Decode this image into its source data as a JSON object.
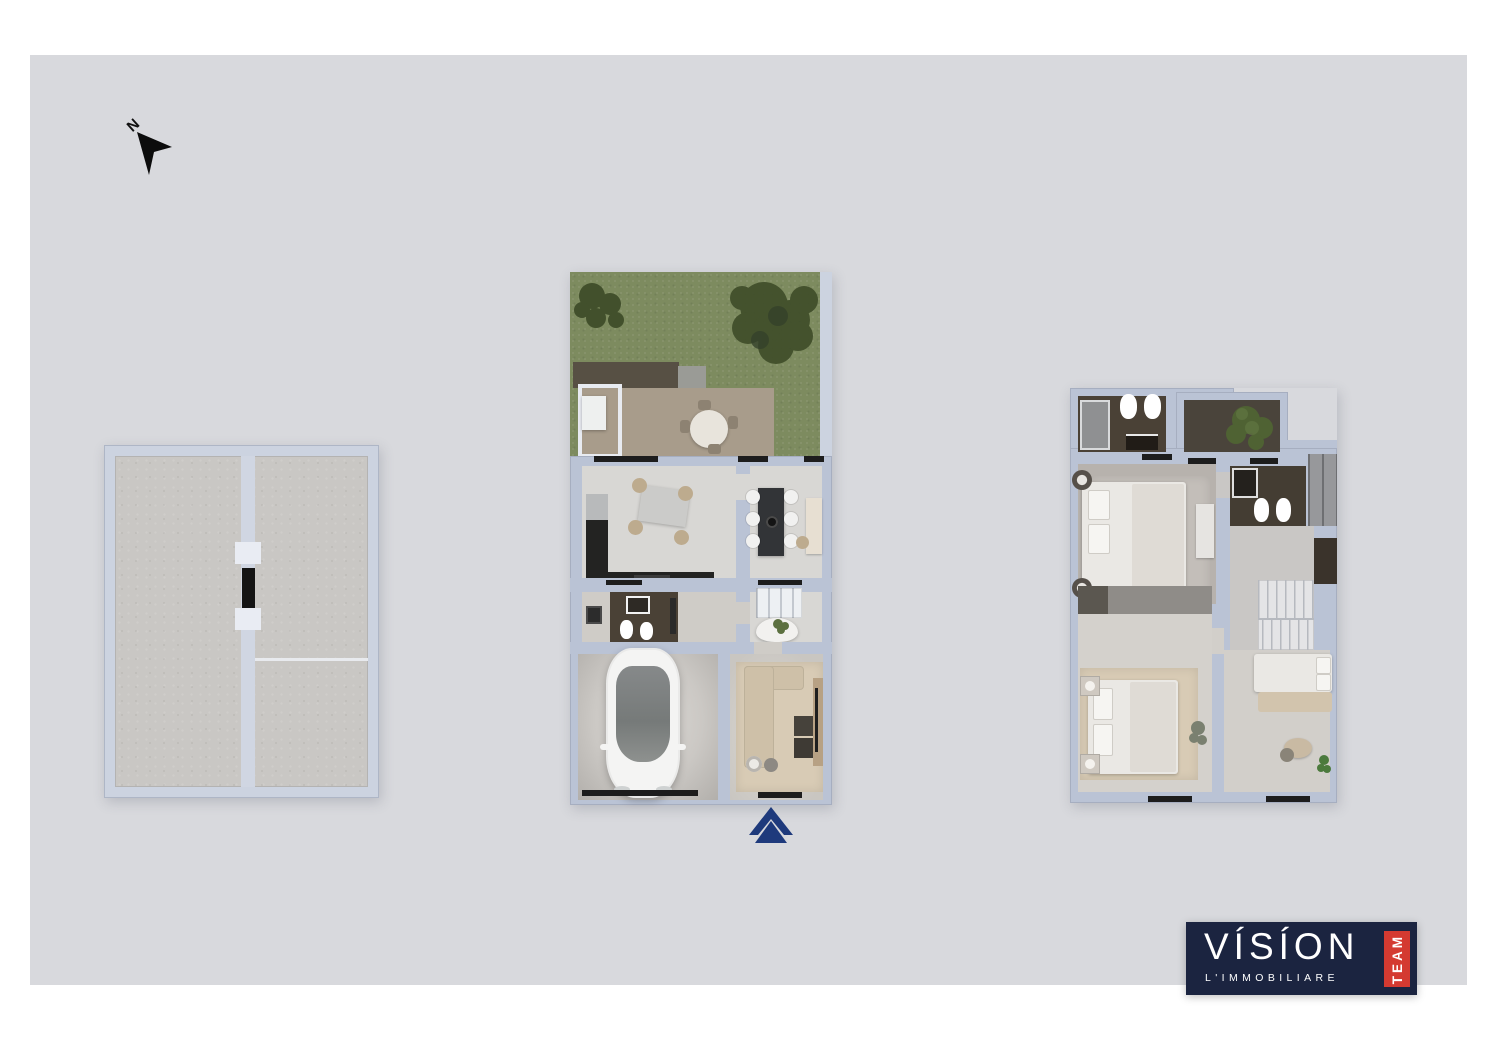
{
  "compass": {
    "label": "N"
  },
  "logo": {
    "brand": "VISION",
    "brand_display": "VÍSÍON",
    "subtitle": "L'IMMOBILIARE",
    "badge": "TEAM"
  },
  "palette": {
    "page_bg": "#ffffff",
    "canvas_bg": "#d8d9dd",
    "wall": "#bac3d5",
    "wall_light": "#ccd3e0",
    "wall_pale": "#e9ecf3",
    "roof_floor": "#c9c7c4",
    "grass": "#7d8b5f",
    "tree": "#42502c",
    "terrace": "#a89c8b",
    "pergola": "#575044",
    "roof_gray": "#9a9b96",
    "floor": "#d8d7d4",
    "floor_warm": "#cfccc7",
    "floor_dark": "#4a4136",
    "counter": "#232322",
    "island": "#323437",
    "steel": "#b8babb",
    "chair_beige": "#bdab8e",
    "sofa": "#cec0a8",
    "rug": "#d8cbb5",
    "car_body": "#f4f4f3",
    "car_glass": "#90948f",
    "bed": "#eae8e4",
    "stairs": "#e4e4e6",
    "cabinet_gray": "#97989b",
    "dark_brown": "#3a332b",
    "desk": "#e7dfd2",
    "wood": "#b7a184",
    "ink": "#1d1d1d",
    "logo_navy": "#1b2440",
    "logo_red": "#d43a31",
    "arrow_navy": "#1e3a7c",
    "white": "#ffffff"
  }
}
